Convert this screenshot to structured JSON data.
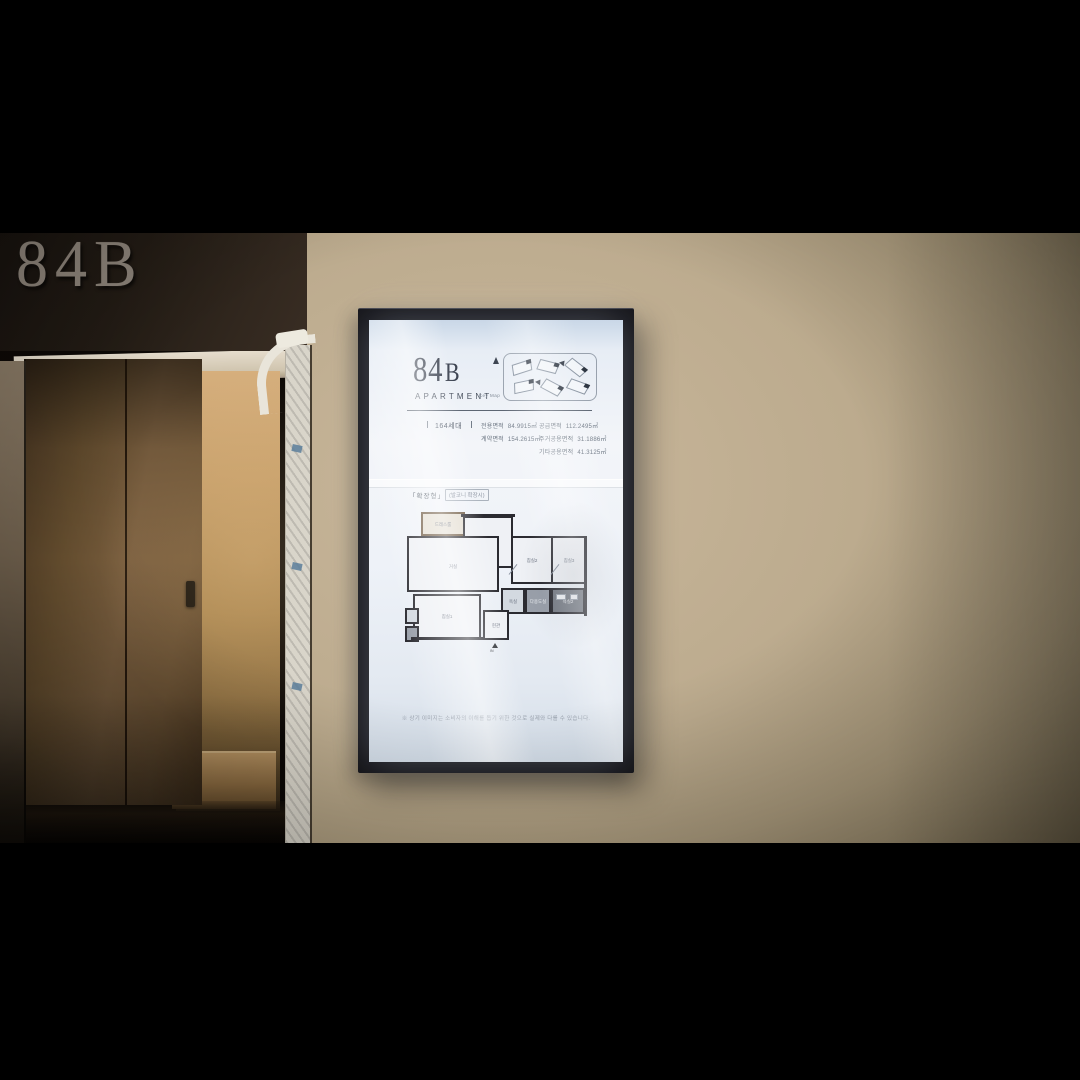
{
  "scene": {
    "hall_sign": "84B"
  },
  "signage": {
    "unit_number": "84",
    "unit_letter": "B",
    "subtitle": "APARTMENT",
    "key_map_caption": "Key Map",
    "households": "164세대",
    "areas_left": [
      {
        "label": "전용면적",
        "value": "84.9915㎡"
      },
      {
        "label": "계약면적",
        "value": "154.2615㎡"
      }
    ],
    "areas_right": [
      {
        "label": "공급면적",
        "value": "112.2495㎡"
      },
      {
        "label": "주거공용면적",
        "value": "31.1886㎡"
      },
      {
        "label": "기타공용면적",
        "value": "41.3125㎡"
      }
    ],
    "plan_section": {
      "type_label": "「확장형」",
      "type_note": "(발코니 확장시)",
      "entrance_mark": "IN",
      "rooms": {
        "living": "거실",
        "kitchen": "주방/식당",
        "bed1": "침실1",
        "bed2": "침실2",
        "bed3": "침실3",
        "bath1": "욕실",
        "bath2": "욕실2",
        "entrance": "현관",
        "dress": "드레스룸",
        "utility": "다용도실"
      }
    },
    "disclaimer": "※ 상기 이미지는 소비자의 이해를 돕기 위한 것으로 실제와 다를 수 있습니다."
  },
  "colors": {
    "wall_beige": "#bcab8e",
    "wall_dark": "#221b14",
    "frame_black": "#131318",
    "screen_ink": "#3d4452",
    "wood": "#7c6040"
  }
}
